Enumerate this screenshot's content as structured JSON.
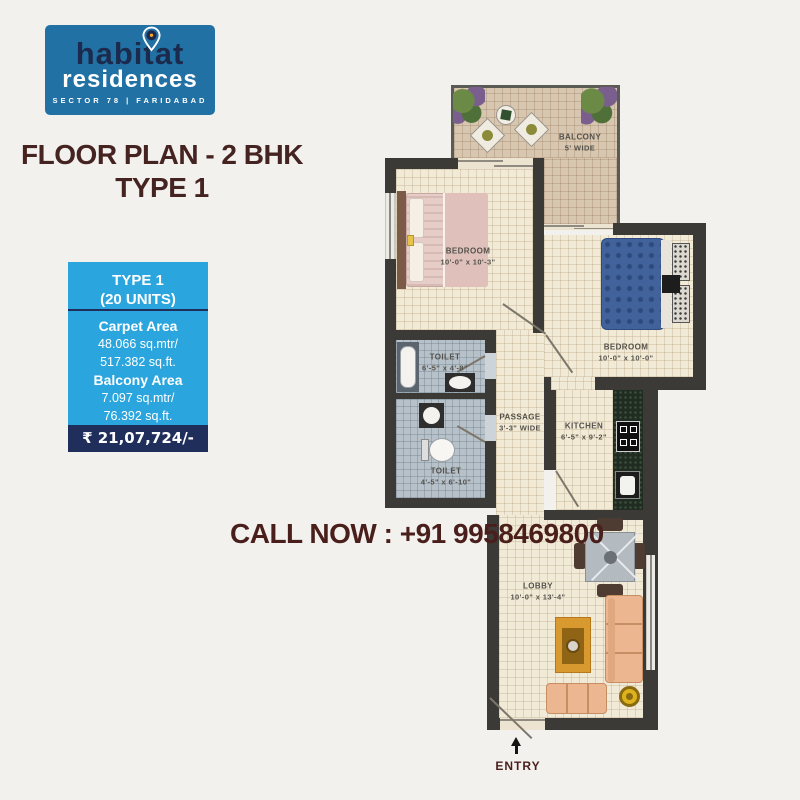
{
  "logo": {
    "brand_line1": "habitat",
    "brand_line2": "residences",
    "tagline": "SECTOR 78 | FARIDABAD",
    "bg_color": "#2171a4",
    "brand1_color": "#1c2b4d",
    "pin_accent_color": "#f5a623"
  },
  "heading": {
    "line1": "FLOOR PLAN - 2 BHK",
    "line2": "TYPE 1",
    "color": "#452320"
  },
  "info_box": {
    "type_line1": "TYPE 1",
    "type_line2": "(20 UNITS)",
    "carpet_label": "Carpet Area",
    "carpet_mtr": "48.066 sq.mtr/",
    "carpet_ft": "517.382 sq.ft.",
    "balcony_label": "Balcony Area",
    "balcony_mtr": "7.097 sq.mtr/",
    "balcony_ft": "76.392 sq.ft.",
    "price": "₹ 21,07,724/-",
    "bg_color": "#2ba5dd",
    "strip_color": "#202e5c"
  },
  "call_now": {
    "text": "CALL NOW : +91 9958469800",
    "color": "#4a1f1b"
  },
  "floor_plan": {
    "rooms": [
      {
        "name": "BALCONY",
        "dims": "5' WIDE"
      },
      {
        "name": "BEDROOM",
        "dims": "10'-0\" x 10'-3\""
      },
      {
        "name": "BEDROOM",
        "dims": "10'-0\" x 10'-0\""
      },
      {
        "name": "TOILET",
        "dims": "6'-5\" x 4'-8\""
      },
      {
        "name": "TOILET",
        "dims": "4'-5\" x 6'-10\""
      },
      {
        "name": "PASSAGE",
        "dims": "3'-3\" WIDE"
      },
      {
        "name": "KITCHEN",
        "dims": "6'-5\" x 9'-2\""
      },
      {
        "name": "LOBBY",
        "dims": "10'-0\" x 13'-4\""
      }
    ],
    "entry_label": "ENTRY",
    "wall_color": "#3b3a37",
    "floor_color": "#f1ead7",
    "balcony_floor_color": "#d7c6b0",
    "toilet_floor_color": "#b7c1c9"
  }
}
